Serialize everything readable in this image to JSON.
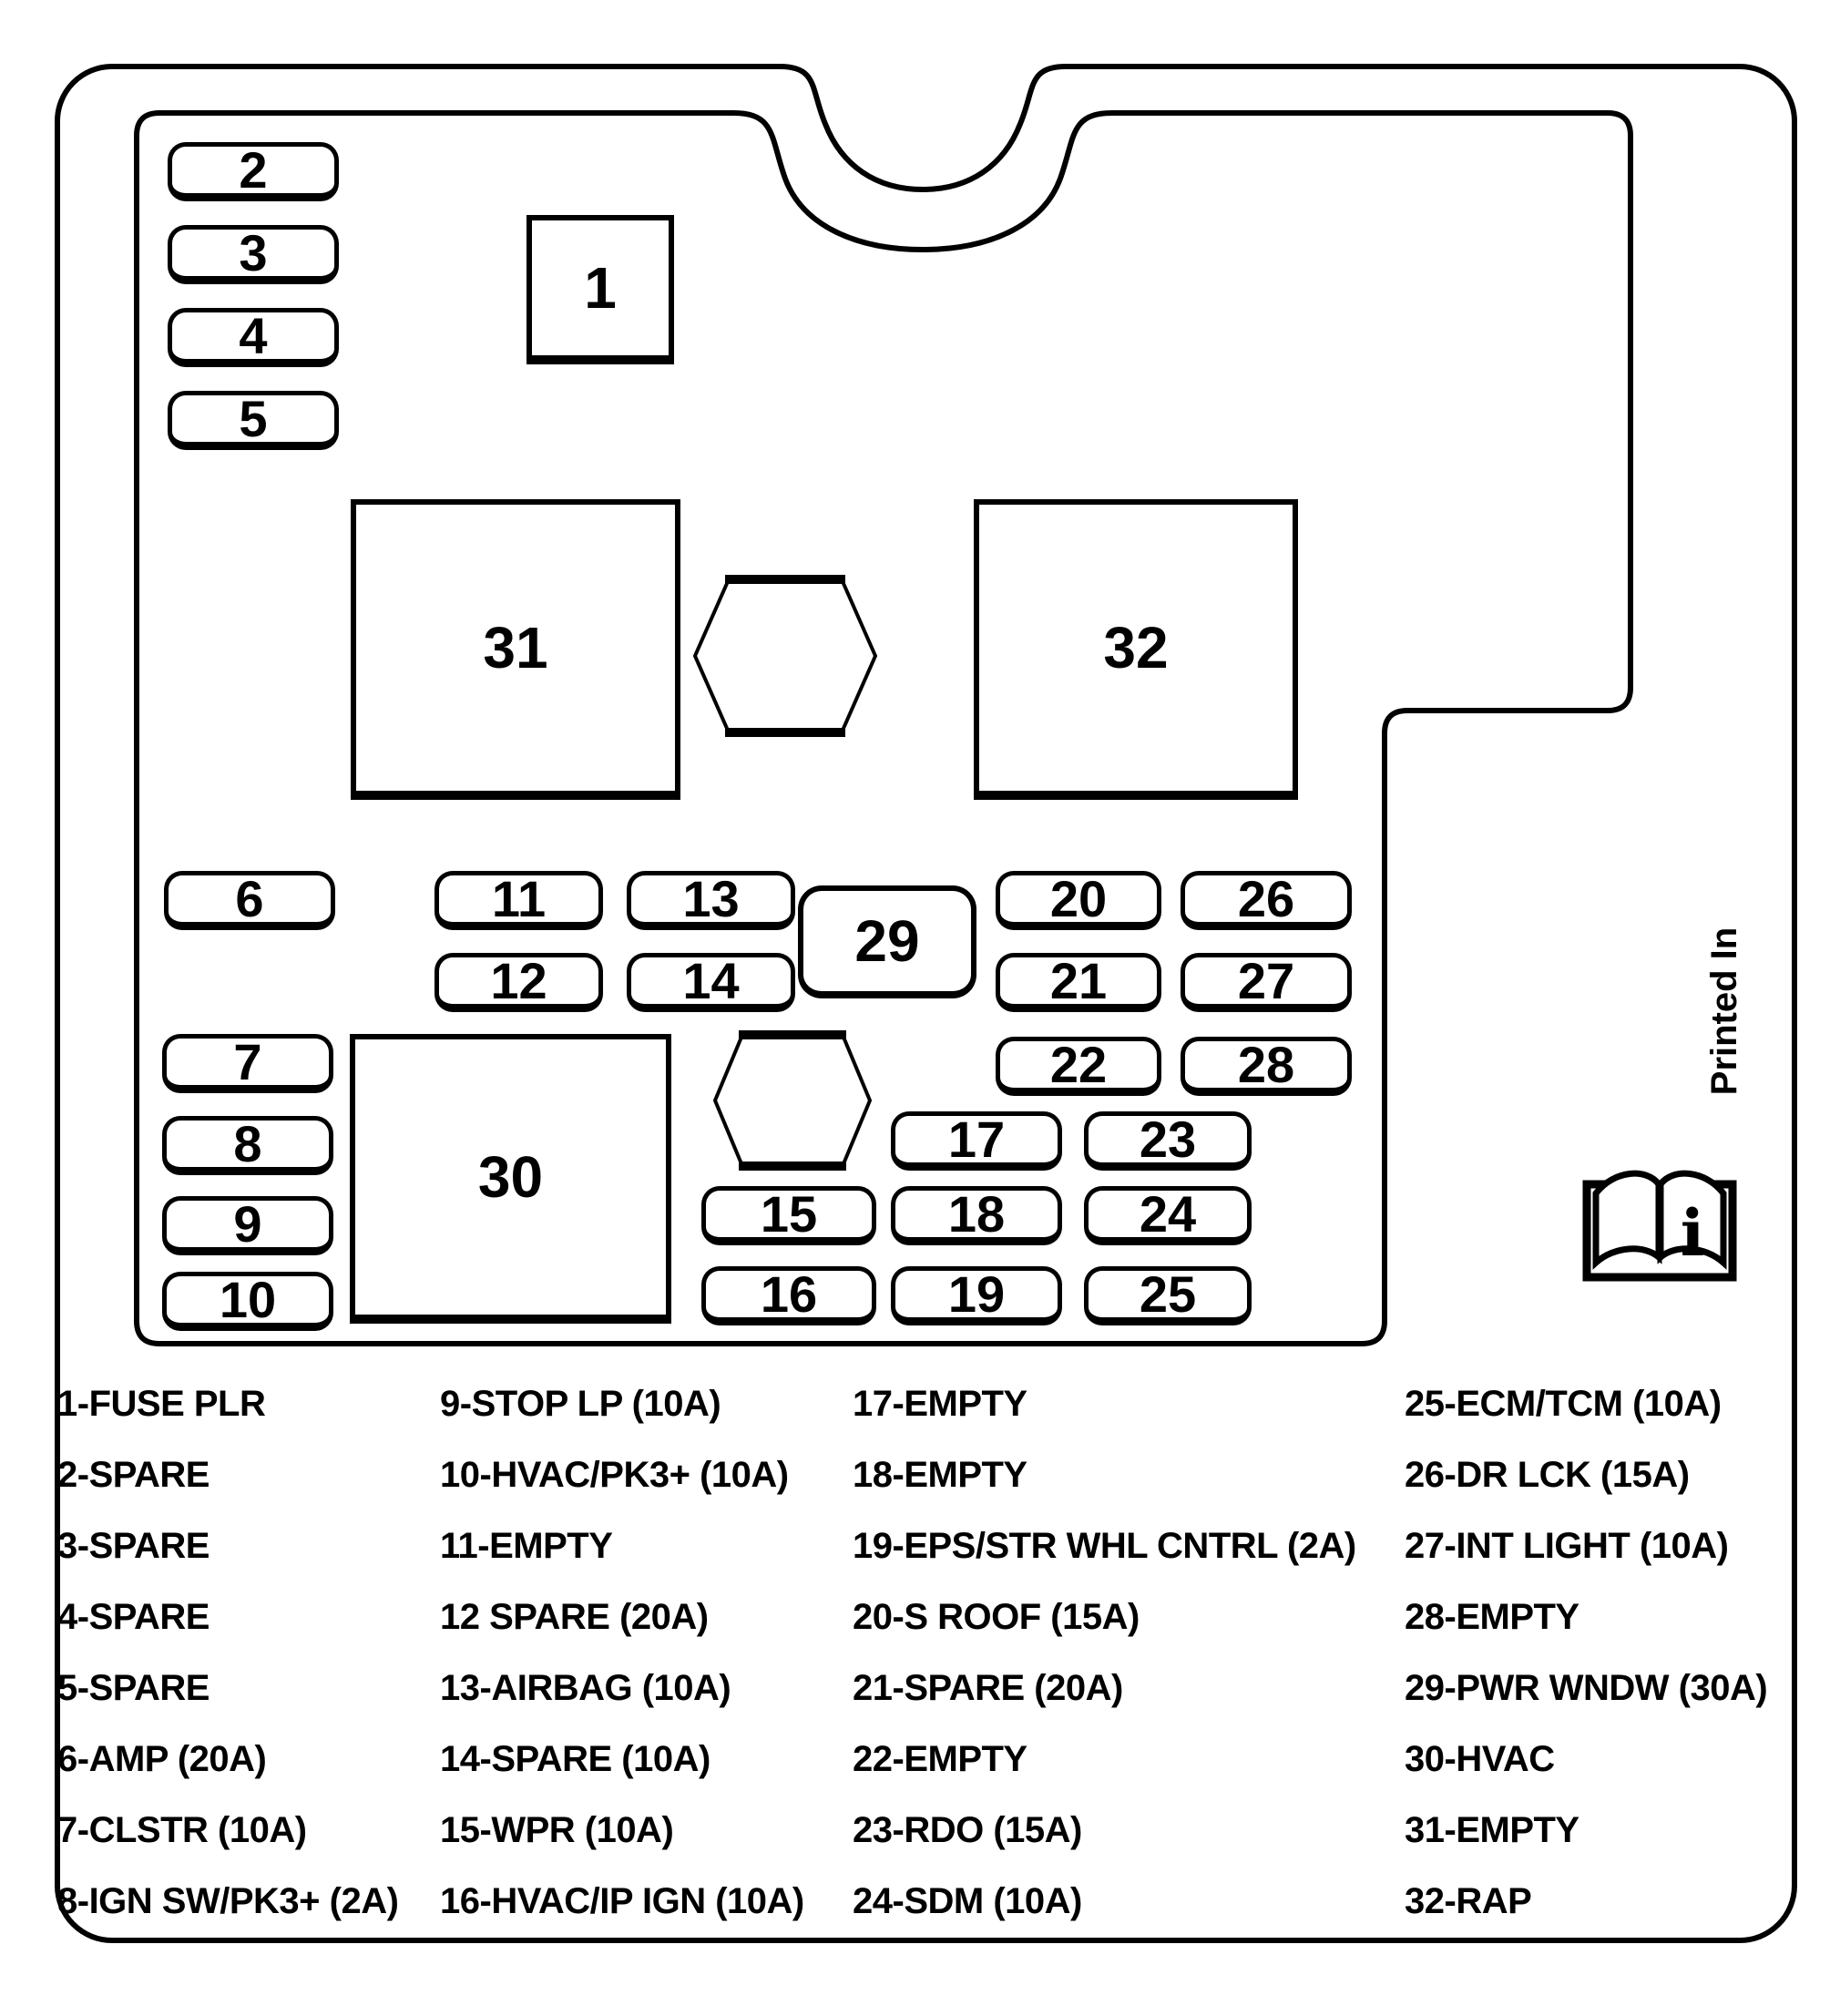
{
  "colors": {
    "line": "#000000",
    "background": "#ffffff"
  },
  "fuse_labels": [
    "1",
    "2",
    "3",
    "4",
    "5",
    "6",
    "7",
    "8",
    "9",
    "10",
    "11",
    "12",
    "13",
    "14",
    "15",
    "16",
    "17",
    "18",
    "19",
    "20",
    "21",
    "22",
    "23",
    "24",
    "25",
    "26",
    "27",
    "28",
    "29",
    "30",
    "31",
    "32"
  ],
  "annotations": {
    "printed_in": "Printed In",
    "book_icon_glyph": "i"
  },
  "legend": {
    "col1": [
      "1-FUSE PLR",
      "2-SPARE",
      "3-SPARE",
      "4-SPARE",
      "5-SPARE",
      "6-AMP (20A)",
      "7-CLSTR (10A)",
      "8-IGN SW/PK3+ (2A)"
    ],
    "col2": [
      "9-STOP LP (10A)",
      "10-HVAC/PK3+ (10A)",
      "11-EMPTY",
      "12 SPARE (20A)",
      "13-AIRBAG (10A)",
      "14-SPARE (10A)",
      "15-WPR (10A)",
      "16-HVAC/IP IGN (10A)"
    ],
    "col3": [
      "17-EMPTY",
      "18-EMPTY",
      "19-EPS/STR WHL CNTRL (2A)",
      "20-S ROOF (15A)",
      "21-SPARE (20A)",
      "22-EMPTY",
      "23-RDO (15A)",
      "24-SDM (10A)"
    ],
    "col4": [
      "25-ECM/TCM (10A)",
      "26-DR LCK (15A)",
      "27-INT LIGHT (10A)",
      "28-EMPTY",
      "29-PWR WNDW (30A)",
      "30-HVAC",
      "31-EMPTY",
      "32-RAP"
    ]
  }
}
